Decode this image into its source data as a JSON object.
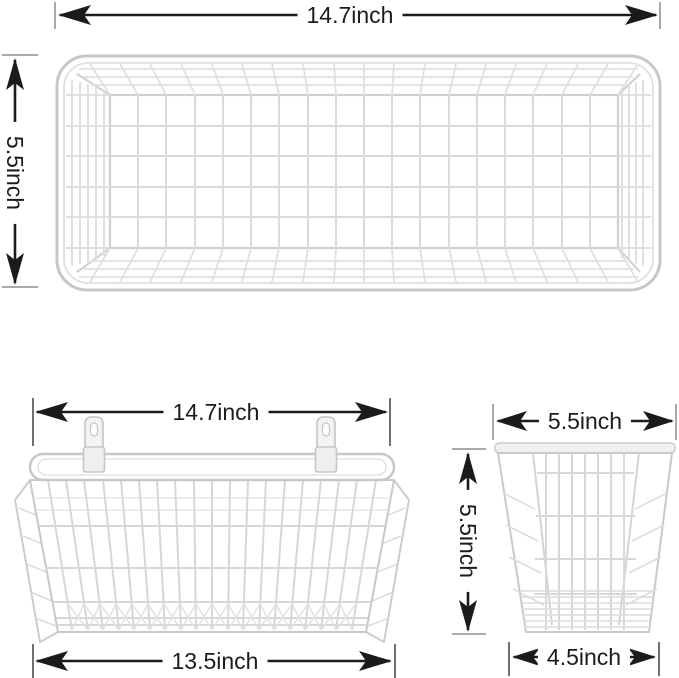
{
  "unit": "inch",
  "colors": {
    "background": "#ffffff",
    "dimension_line": "#1b1b1b",
    "tick_gray": "#a9a9a9",
    "tick_dark": "#6f6f6f",
    "wire_frame": "#c7c7c7",
    "wire_grid": "#d7d7d7",
    "bracket_fill": "#f3f3f3"
  },
  "top_view": {
    "width_label": "14.7inch",
    "height_label": "5.5inch"
  },
  "front_view": {
    "top_width_label": "14.7inch",
    "bottom_width_label": "13.5inch"
  },
  "side_view": {
    "top_width_label": "5.5inch",
    "height_label": "5.5inch",
    "bottom_width_label": "4.5inch"
  }
}
